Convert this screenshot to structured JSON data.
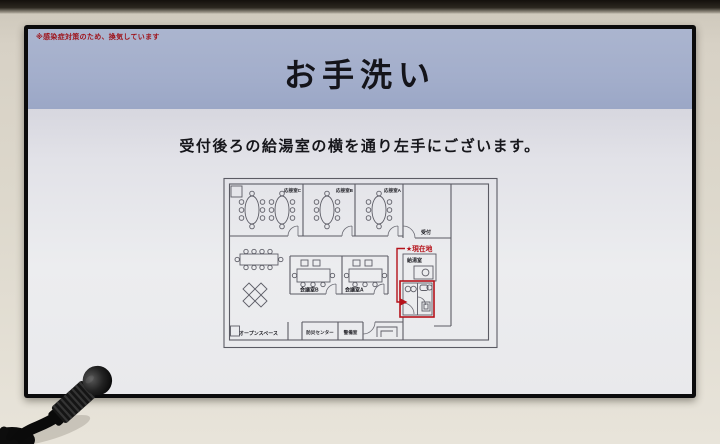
{
  "kiosk": {
    "notice": "※感染症対策のため、換気しています",
    "title": "お手洗い",
    "instruction": "受付後ろの給湯室の横を通り左手にございます。",
    "map": {
      "rooms": {
        "reception_c": "応接室C",
        "reception_b": "応接室B",
        "reception_a": "応接室A",
        "front_desk": "受付",
        "kitchenette": "給湯室",
        "meeting_b": "会議室B",
        "meeting_a": "会議室A",
        "open_space": "オープンスペース",
        "disaster_center": "防災センター",
        "security_room": "警備室"
      },
      "current_location": "★現在地",
      "highlight_color": "#b5121a"
    },
    "buttons": {
      "back_icon": "←",
      "back_label": "戻る",
      "home_icon": "⌂",
      "home_label": "ホーム"
    },
    "brand": {
      "logo_line1": "SMART",
      "logo_line2": "BUILDING",
      "company": "SMART Building Inc."
    },
    "colors": {
      "header_band": "#a3aecb",
      "alert_red": "#9e1118"
    }
  }
}
